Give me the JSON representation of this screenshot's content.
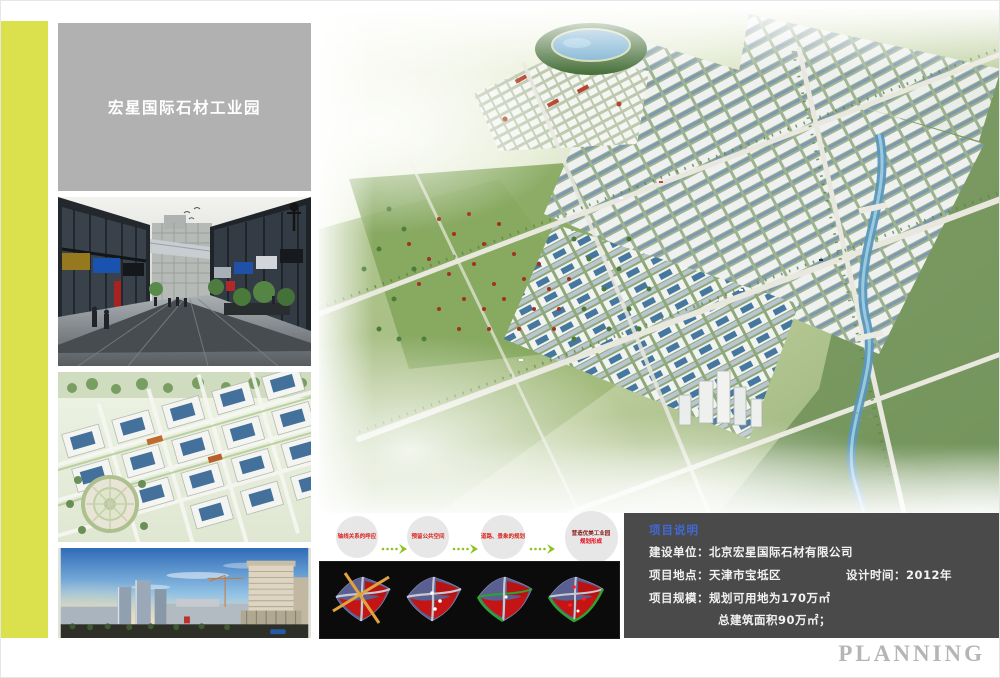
{
  "page": {
    "background": "#ffffff"
  },
  "theme": {
    "accent_stripe": "#dbe14d",
    "title_panel_bg": "#b1b1b1",
    "title_text": "#ffffff",
    "info_panel_bg": "#4a4a4a",
    "info_heading_blue": "#4169d6",
    "step_text_red": "#d9251c",
    "arrow_green": "#8fc31f",
    "flow_circle_bg": "#e7e7e7",
    "diagram_box_bg": "#0b0b0b",
    "planning_gray": "#b5b5b5"
  },
  "title_panel": {
    "title": "宏星国际石材工业园"
  },
  "thumbnails": [
    {
      "name": "street-view-rendering"
    },
    {
      "name": "aerial-industrial-park-rendering"
    },
    {
      "name": "city-skyline-rendering"
    }
  ],
  "flow": {
    "steps": [
      {
        "label": "轴线关系的呼应"
      },
      {
        "label": "预留公共空间"
      },
      {
        "label": "道路、景象的规划"
      },
      {
        "label": "营造优美工业园",
        "sublabel": "规划形成"
      }
    ]
  },
  "concept_diagrams": [
    {
      "name": "concept-step-1-axes"
    },
    {
      "name": "concept-step-2-nodes"
    },
    {
      "name": "concept-step-3-greenways"
    },
    {
      "name": "concept-step-4-plan"
    }
  ],
  "info": {
    "heading": "项目说明",
    "row1": {
      "label": "建设单位：",
      "value": "北京宏星国际石材有限公司"
    },
    "row2": {
      "label": "项目地点：",
      "value": "天津市宝坻区"
    },
    "row2b": {
      "label": "设计时间：",
      "value": "2012年"
    },
    "row3": {
      "label": "项目规模：",
      "value": "规划可用地为170万㎡"
    },
    "row4": {
      "value": "总建筑面积90万㎡；"
    }
  },
  "footer": {
    "brand": "PLANNING"
  }
}
